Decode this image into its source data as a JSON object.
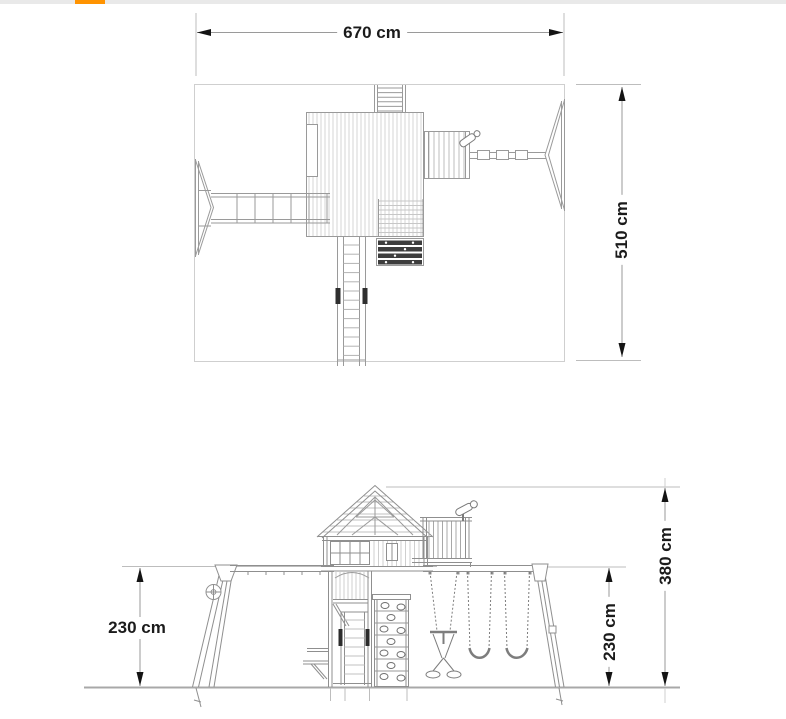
{
  "top_bar": {
    "track_color": "#e9e9e9",
    "accent_color": "#ff9300"
  },
  "document": {
    "type": "playset technical dimension drawing",
    "views": [
      "top plan view",
      "side elevation view"
    ]
  },
  "dimensions": {
    "plan_width": {
      "label": "670 cm"
    },
    "plan_depth": {
      "label": "510 cm"
    },
    "beam_height": {
      "label": "230 cm"
    },
    "swing_beam_height": {
      "label": "230 cm"
    },
    "overall_height": {
      "label": "380 cm"
    }
  },
  "drawing_colors": {
    "linework": "#8f8f8f",
    "dimension_line": "#9a9a9a",
    "extension_line": "#bdbdbd",
    "arrow": "#141414",
    "text": "#1b1b1b"
  }
}
